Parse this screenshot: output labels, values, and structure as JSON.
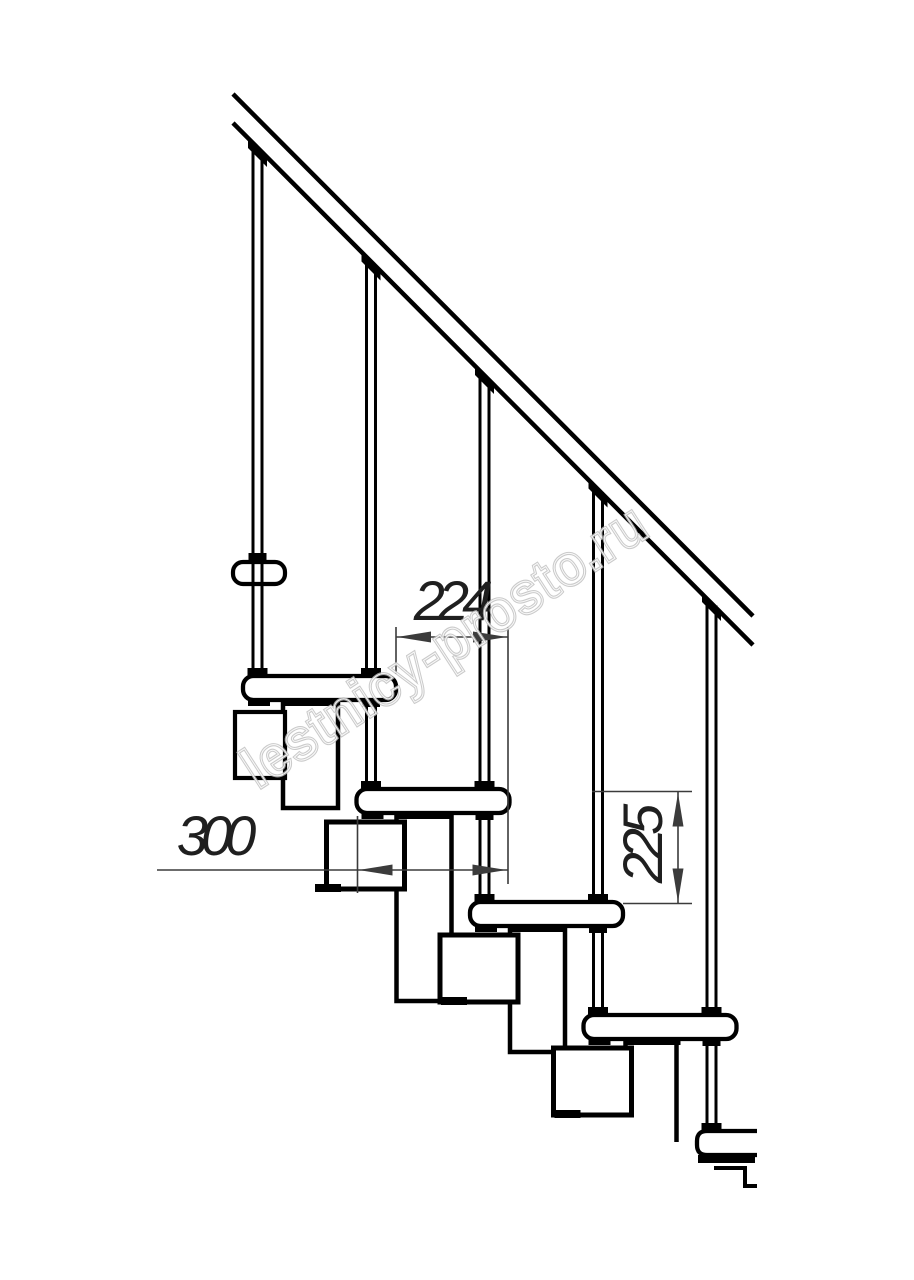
{
  "drawing": {
    "type": "modular-staircase-side-view",
    "dimension_labels": {
      "run": "224",
      "tread_depth": "300",
      "rise": "225"
    },
    "watermark_text": "lestnicy-prosto.ru",
    "colors": {
      "line": "#000000",
      "dimension": "#3b3b3b",
      "dimension_text": "#1f1f1f",
      "watermark": "#bdbdbd",
      "watermark_inner": "#ffffff",
      "background": "#ffffff"
    }
  }
}
